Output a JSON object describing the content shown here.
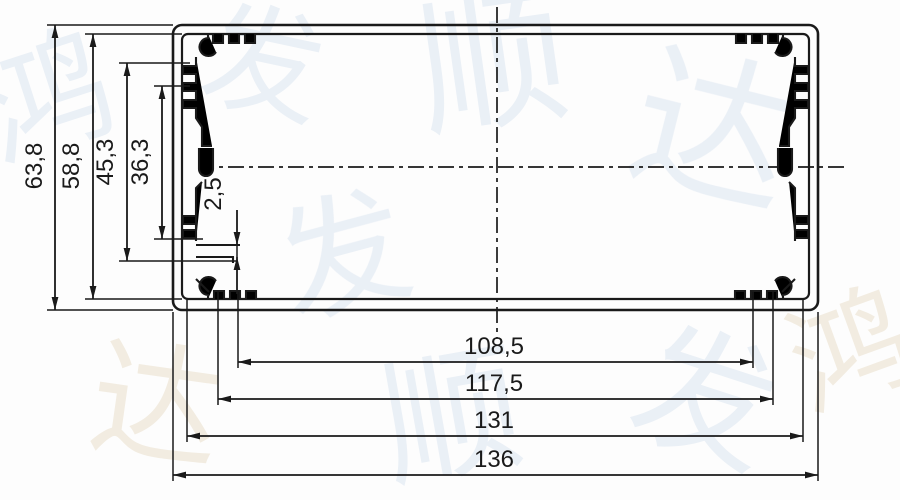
{
  "colors": {
    "ink": "#1a1a1a",
    "background": "#fdfdfd"
  },
  "watermark": {
    "chars": [
      "鸿",
      "发",
      "顺",
      "达"
    ],
    "color_blue": "#dbe5f1",
    "color_tan": "#eadfca"
  },
  "dims": {
    "vertical": [
      {
        "label": "63,8"
      },
      {
        "label": "58,8"
      },
      {
        "label": "45,3"
      },
      {
        "label": "36,3"
      }
    ],
    "detail": {
      "label": "2,5"
    },
    "horizontal": [
      {
        "label": "108,5"
      },
      {
        "label": "117,5"
      },
      {
        "label": "131"
      },
      {
        "label": "136"
      }
    ]
  }
}
